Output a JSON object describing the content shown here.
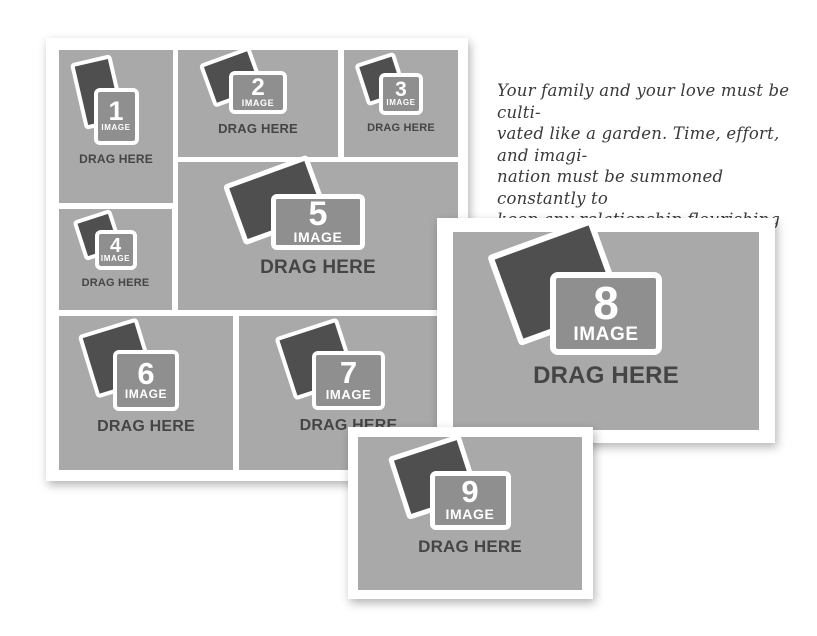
{
  "colors": {
    "page_background": "#ffffff",
    "frame_white": "#ffffff",
    "cell_gray": "#a9a9a9",
    "placeholder_box_gray": "#8f8f8f",
    "photo_dark_gray": "#4f4f4f",
    "drag_text_gray": "#454545"
  },
  "icons": {
    "photo_stack": "photo-stack-icon"
  },
  "slots": [
    {
      "number": "1",
      "image_label": "IMAGE",
      "drag_label": "DRAG HERE"
    },
    {
      "number": "2",
      "image_label": "IMAGE",
      "drag_label": "DRAG HERE"
    },
    {
      "number": "3",
      "image_label": "IMAGE",
      "drag_label": "DRAG HERE"
    },
    {
      "number": "4",
      "image_label": "IMAGE",
      "drag_label": "DRAG HERE"
    },
    {
      "number": "5",
      "image_label": "IMAGE",
      "drag_label": "DRAG HERE"
    },
    {
      "number": "6",
      "image_label": "IMAGE",
      "drag_label": "DRAG HERE"
    },
    {
      "number": "7",
      "image_label": "IMAGE",
      "drag_label": "DRAG HERE"
    },
    {
      "number": "8",
      "image_label": "IMAGE",
      "drag_label": "DRAG HERE"
    },
    {
      "number": "9",
      "image_label": "IMAGE",
      "drag_label": "DRAG HERE"
    }
  ],
  "quote": {
    "lines": [
      "Your family and your love must be culti-",
      "vated like a garden. Time, effort, and imagi-",
      "nation must be summoned constantly to",
      "keep any relationship flourishing and",
      "growing."
    ],
    "attribution": "- Jim Rohn"
  }
}
